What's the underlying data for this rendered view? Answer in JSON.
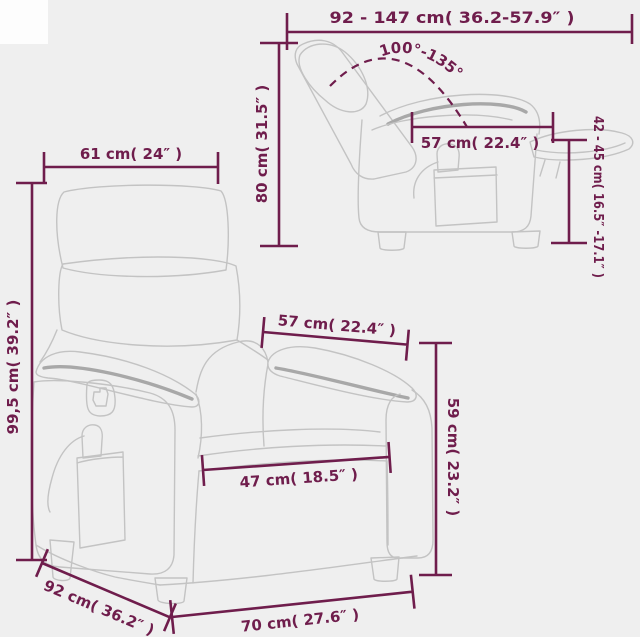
{
  "colors": {
    "accent": "#6f1d4c",
    "chair_line": "#c3c3c3",
    "chair_accent": "#a8a8a8",
    "background": "#efefef",
    "corner_patch": "#fdfdfd"
  },
  "dimensions": {
    "overall_depth_range": "92 - 147 cm( 36.2-57.9″ )",
    "recline_angle": "100°-135°",
    "backrest_height": "80 cm( 31.5″ )",
    "side_seat_width": "57 cm( 22.4″ )",
    "seat_height_range": "42 - 45 cm( 16.5″ -17.1″ )",
    "headrest_width": "61 cm( 24″ )",
    "overall_height": "99,5 cm( 39.2″ )",
    "armrest_length": "57 cm( 22.4″ )",
    "seat_width": "47 cm( 18.5″ )",
    "armrest_height": "59 cm( 23.2″ )",
    "overall_depth": "92 cm( 36.2″ )",
    "overall_width": "70 cm( 27.6″ )"
  }
}
